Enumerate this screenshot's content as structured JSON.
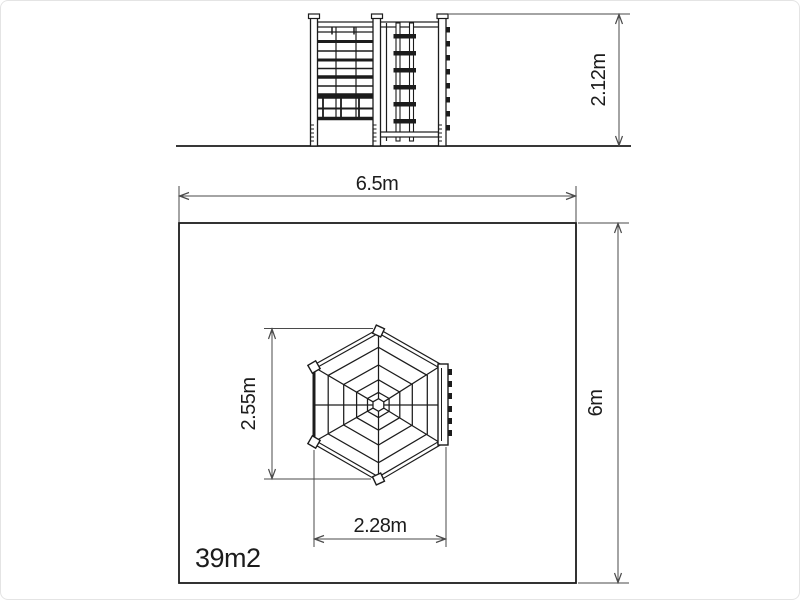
{
  "drawing": {
    "type": "playground-equipment-technical-drawing",
    "colors": {
      "background": "#ffffff",
      "line": "#1c1c1c",
      "dimension_line": "#4a4a4a",
      "text": "#1c1c1c"
    },
    "elevation_view": {
      "height_dimension": "2.12m"
    },
    "plan_view": {
      "safety_area_width_dimension": "6.5m",
      "safety_area_depth_dimension": "6m",
      "equipment_depth_dimension": "2.55m",
      "equipment_width_dimension": "2.28m",
      "area_label": "39m2"
    }
  }
}
